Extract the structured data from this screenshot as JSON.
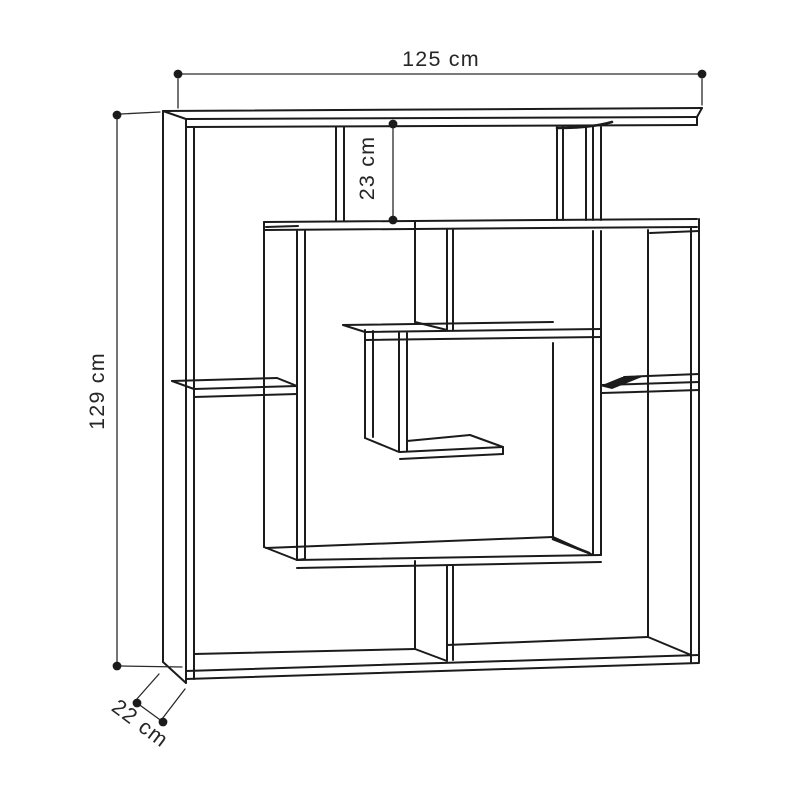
{
  "diagram": {
    "subject": "maze-bookshelf-dimension-drawing",
    "dimensions": {
      "width": {
        "label": "125 cm"
      },
      "height": {
        "label": "129 cm"
      },
      "top_gap": {
        "label": "23 cm"
      },
      "depth": {
        "label": "22 cm"
      }
    },
    "colors": {
      "background": "#ffffff",
      "line": "#1b1b1b",
      "text": "#262626"
    }
  }
}
